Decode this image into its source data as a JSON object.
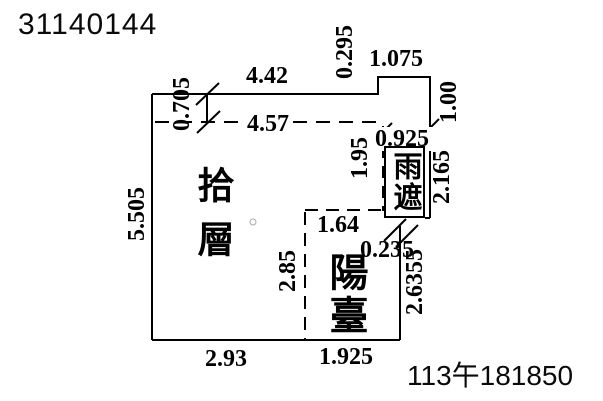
{
  "page": {
    "serial_number": "31140144",
    "stamp": "113午181850"
  },
  "plan": {
    "rooms": {
      "floor_label": "拾層",
      "balcony_label": "陽臺",
      "canopy_label": "雨遮"
    },
    "dimensions": {
      "top_width": "4.42",
      "top_right_offset": "0.295",
      "canopy_top_width": "1.075",
      "upper_left_height": "0.705",
      "interior_top_width": "4.57",
      "canopy_upper_right_height": "1.00",
      "canopy_width": "0.925",
      "canopy_left_height": "1.95",
      "canopy_right_height": "2.165",
      "left_side_height": "5.505",
      "balcony_top_width": "1.64",
      "canopy_balcony_offset": "0.235",
      "balcony_left_height": "2.85",
      "balcony_right_height": "2.6355",
      "bottom_left_width": "2.93",
      "bottom_right_width": "1.925"
    }
  }
}
